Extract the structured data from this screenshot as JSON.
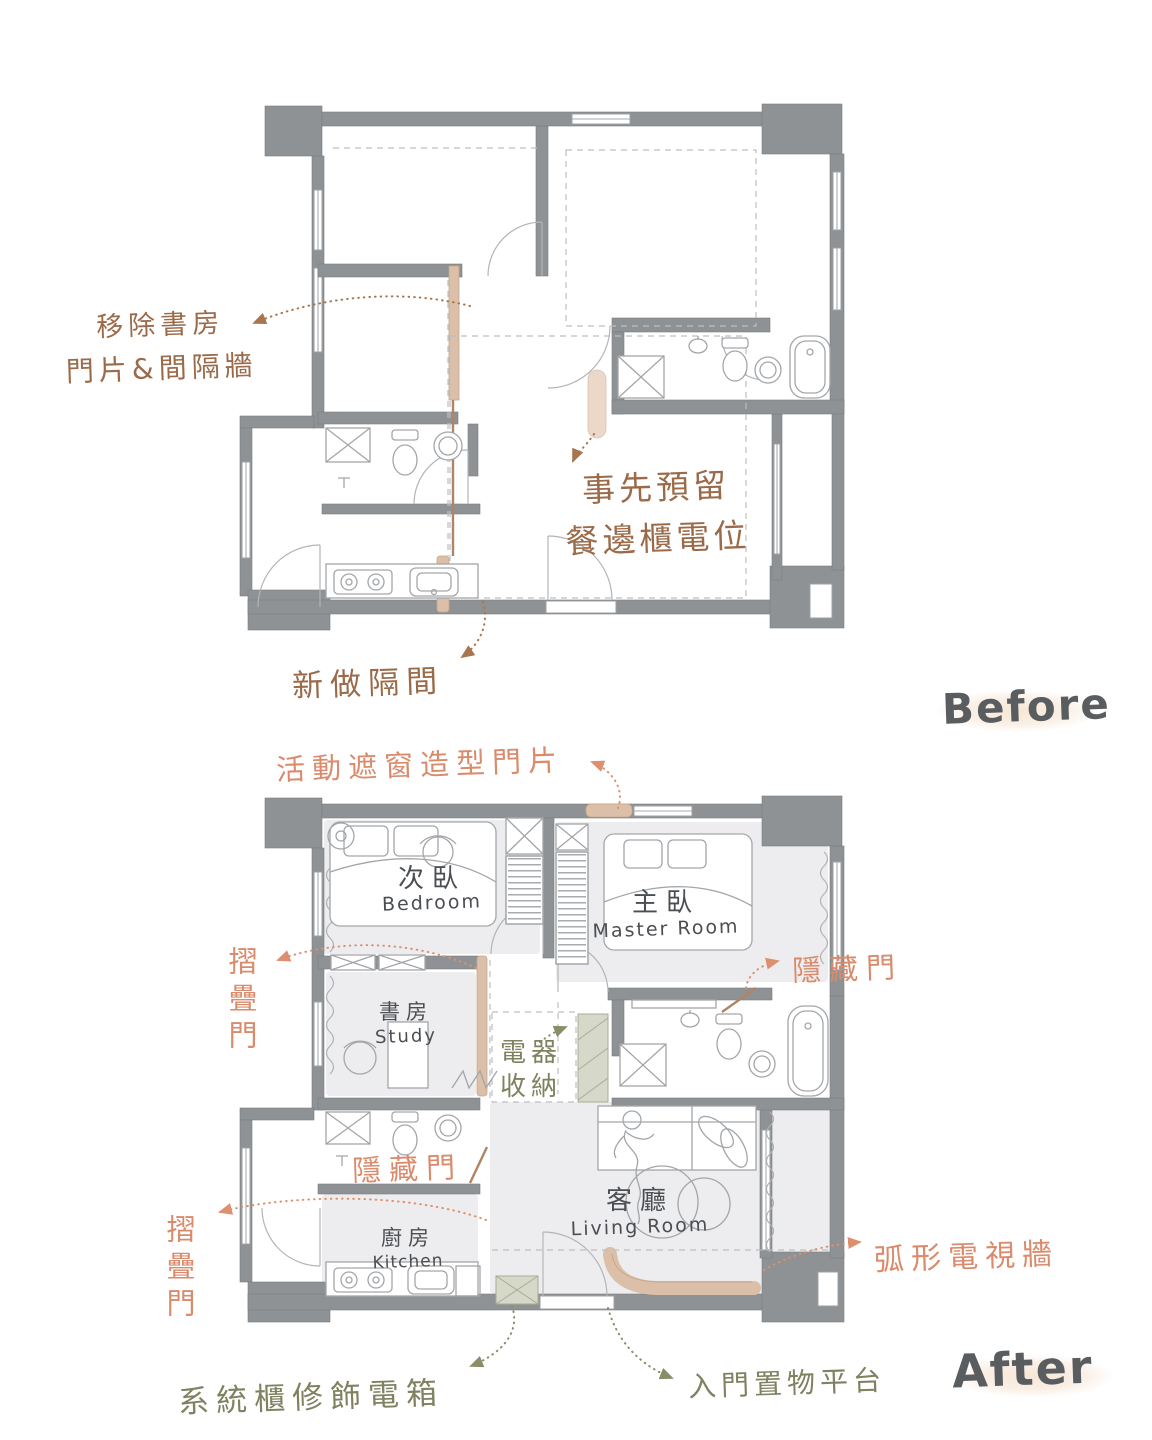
{
  "palette": {
    "wall_gray": "#8f9295",
    "floor_gray": "#ededef",
    "highlight_tan": "#dcbfa8",
    "highlight_sage": "#d6d8ca",
    "annotation_brown": "#9a6a49",
    "annotation_orange": "#d98b6c",
    "annotation_olive": "#7f815f",
    "room_label_gray": "#4b4e52",
    "phase_label_gray": "#5a5d60"
  },
  "before": {
    "title": "Before",
    "annotations": {
      "remove_study_line1": "移除書房",
      "remove_study_line2": "門片&間隔牆",
      "reserve_line1": "事先預留",
      "reserve_line2": "餐邊櫃電位",
      "new_partition": "新做隔間"
    }
  },
  "after": {
    "title": "After",
    "rooms": {
      "bedroom": {
        "zh": "次臥",
        "en": "Bedroom"
      },
      "master": {
        "zh": "主臥",
        "en": "Master Room"
      },
      "study": {
        "zh": "書房",
        "en": "Study"
      },
      "living": {
        "zh": "客廳",
        "en": "Living Room"
      },
      "kitchen": {
        "zh": "廚房",
        "en": "Kitchen"
      }
    },
    "annotations": {
      "movable_screen_door": "活動遮窗造型門片",
      "folding_door_upper": "摺疊門",
      "hidden_door_right": "隱藏門",
      "appliance_line1": "電器",
      "appliance_line2": "收納",
      "hidden_door_left": "隱藏門",
      "folding_door_lower": "摺疊門",
      "curved_tv_wall": "弧形電視牆",
      "system_cabinet": "系統櫃修飾電箱",
      "entry_platform": "入門置物平台"
    }
  }
}
